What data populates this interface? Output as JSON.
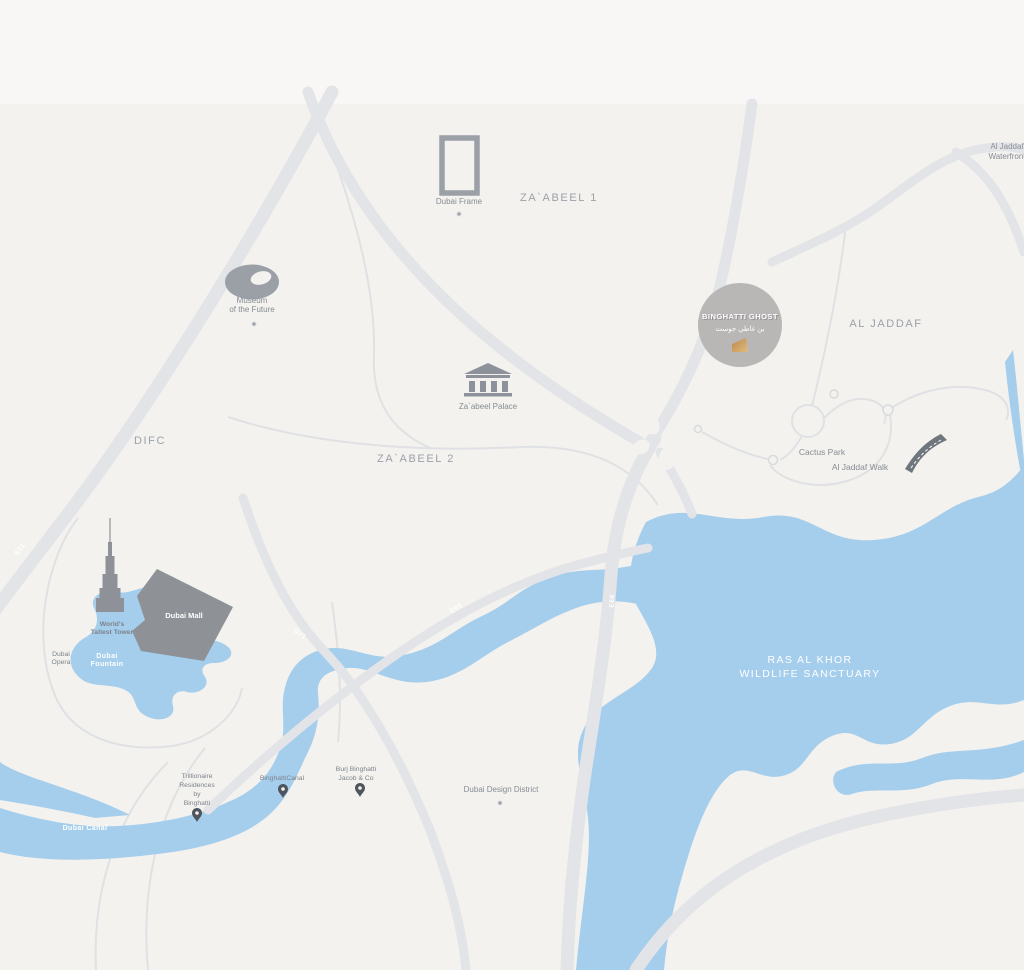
{
  "map": {
    "districts": {
      "zaabeel1": "ZA`ABEEL 1",
      "zaabeel2": "ZA`ABEEL 2",
      "difc": "DIFC",
      "al_jaddaf": "AL JADDAF"
    },
    "landmarks": {
      "dubai_frame": "Dubai Frame",
      "museum_l1": "Museum",
      "museum_l2": "of the Future",
      "zaabeel_palace": "Za`abeel Palace",
      "worlds_tallest_l1": "World's",
      "worlds_tallest_l2": "Tallest Tower",
      "dubai_opera_l1": "Dubai",
      "dubai_opera_l2": "Opera",
      "dubai_mall": "Dubai Mall",
      "dubai_fountain_l1": "Dubai",
      "dubai_fountain_l2": "Fountain",
      "cactus_park": "Cactus Park",
      "al_jaddaf_walk": "Al Jaddaf Walk",
      "al_jaddaf_waterfront_l1": "Al Jaddaf",
      "al_jaddaf_waterfront_l2": "Waterfront",
      "dubai_design_district": "Dubai Design District",
      "trillionaire_l1": "Trillionaire",
      "trillionaire_l2": "Residences",
      "trillionaire_l3": "by",
      "trillionaire_l4": "Binghatti",
      "binghatti_canal": "BinghattiCanal",
      "burj_binghatti_l1": "Burj Binghatti",
      "burj_binghatti_l2": "Jacob & Co"
    },
    "water_labels": {
      "ras_al_khor_l1": "RAS AL KHOR",
      "ras_al_khor_l2": "WILDLIFE SANCTUARY",
      "dubai_canal": "Dubai Canal"
    },
    "roads": {
      "e11": "E11",
      "d71": "D71",
      "d69": "D69",
      "e66": "E66"
    },
    "highlight": {
      "title": "BINGHATTI GHOST",
      "subtitle_ar": "بن غاطي جوست"
    },
    "colors": {
      "background": "#f3f2ee",
      "top_band": "#f8f7f5",
      "water": "#a5cdec",
      "road_major": "#e3e4e8",
      "road_minor": "#e0e1e4",
      "landmark_gray": "#8e939a",
      "mall_gray": "#8e9196",
      "label_gray": "#868c94",
      "district_gray": "#9ba1a9",
      "highlight_circle": "#b9b7b6",
      "highlight_gold": "#c6995c",
      "pin": "#4e555d"
    }
  }
}
